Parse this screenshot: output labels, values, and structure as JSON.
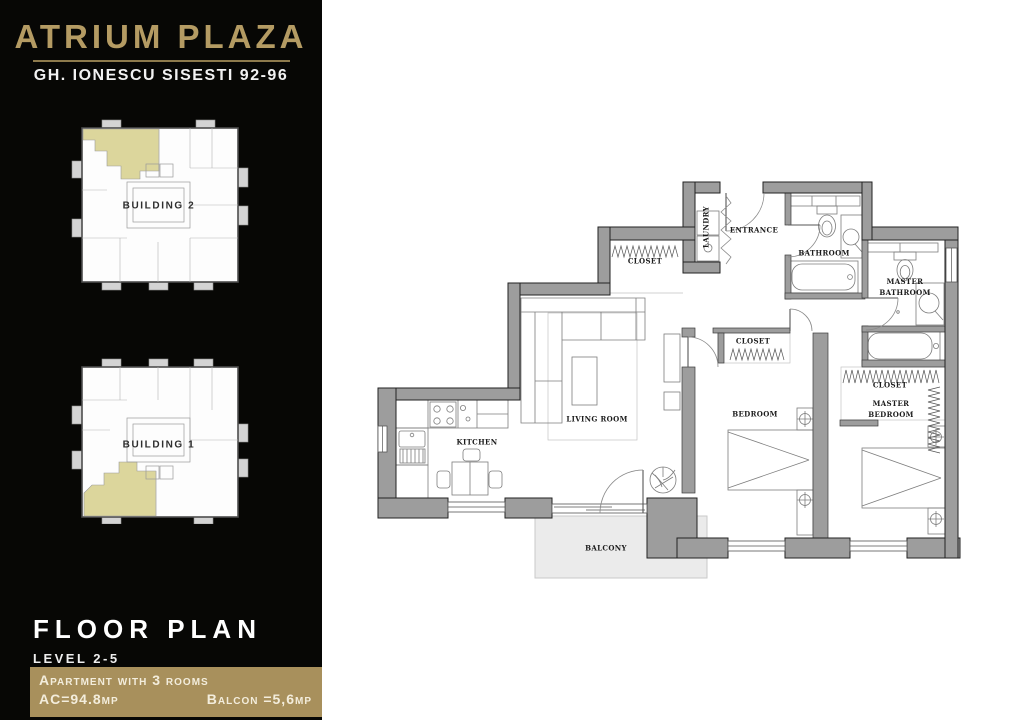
{
  "header": {
    "title": "ATRIUM PLAZA",
    "subtitle": "GH. IONESCU SISESTI 92-96"
  },
  "buildings": [
    {
      "label": "BUILDING 2"
    },
    {
      "label": "BUILDING 1"
    }
  ],
  "plan_info": {
    "heading": "FLOOR PLAN",
    "level": "LEVEL 2-5",
    "apartment": "Apartment with 3 rooms",
    "ac": "AC=94.8mp",
    "balcony": "Balcon =5,6mp"
  },
  "rooms": {
    "laundry": "LAUNDRY",
    "entrance": "ENTRANCE",
    "bathroom": "BATHROOM",
    "master_bathroom": "MASTER BATHROOM",
    "hall_closet": "CLOSET",
    "bedroom_closet": "CLOSET",
    "master_closet": "CLOSET",
    "living_room": "LIVING ROOM",
    "kitchen": "KITCHEN",
    "bedroom": "BEDROOM",
    "master_bedroom": "MASTER BEDROOM",
    "balcony": "BALCONY"
  },
  "colors": {
    "gold": "#b49b63",
    "gold_box": "#a8905c",
    "highlight": "#dcd69c",
    "wall": "#9d9d9d",
    "sidebar_bg": "#070705"
  }
}
